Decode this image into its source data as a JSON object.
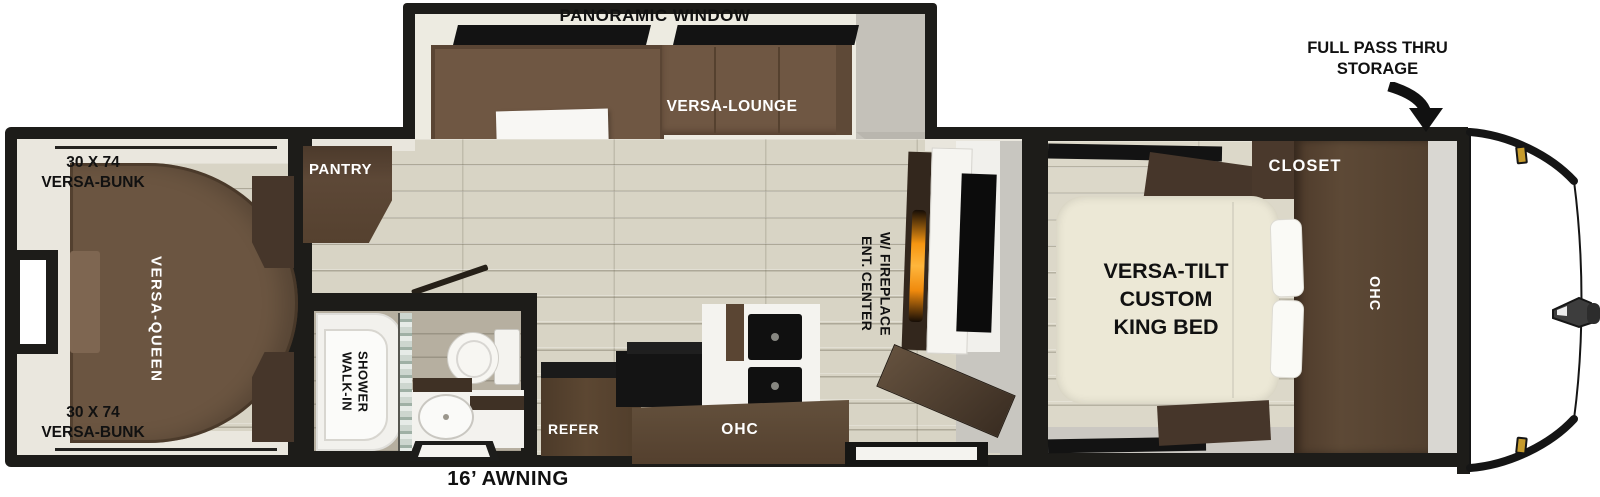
{
  "labels": {
    "panoramic_window": "PANORAMIC WINDOW",
    "versa_lounge": "VERSA-LOUNGE",
    "pantry": "PANTRY",
    "versa_queen": "VERSA-QUEEN",
    "bunk_top": "30 X 74\nVERSA-BUNK",
    "bunk_bottom": "30 X 74\nVERSA-BUNK",
    "walk_in_shower": "WALK-IN\nSHOWER",
    "refer": "REFER",
    "kitchen_ohc": "OHC",
    "ent_center": "ENT. CENTER\nW/ FIREPLACE",
    "king_bed": "VERSA-TILT\nCUSTOM\nKING BED",
    "closet": "CLOSET",
    "bedroom_ohc": "OHC",
    "pass_thru": "FULL PASS THRU\nSTORAGE",
    "awning": "16’ AWNING"
  },
  "palette": {
    "wall_black": "#1d1c19",
    "floor_plank": "#d8d4c5",
    "sofa_brown": "#6f5743",
    "cabinet_dark_brown": "#46362a",
    "counter_brown": "#5c4835",
    "bed_cream": "#ece8d6",
    "interior_trim": "#eae7de",
    "fireplace_orange": "#f59511",
    "marker_gold": "#c69b2c",
    "nose_white": "#ffffff"
  }
}
